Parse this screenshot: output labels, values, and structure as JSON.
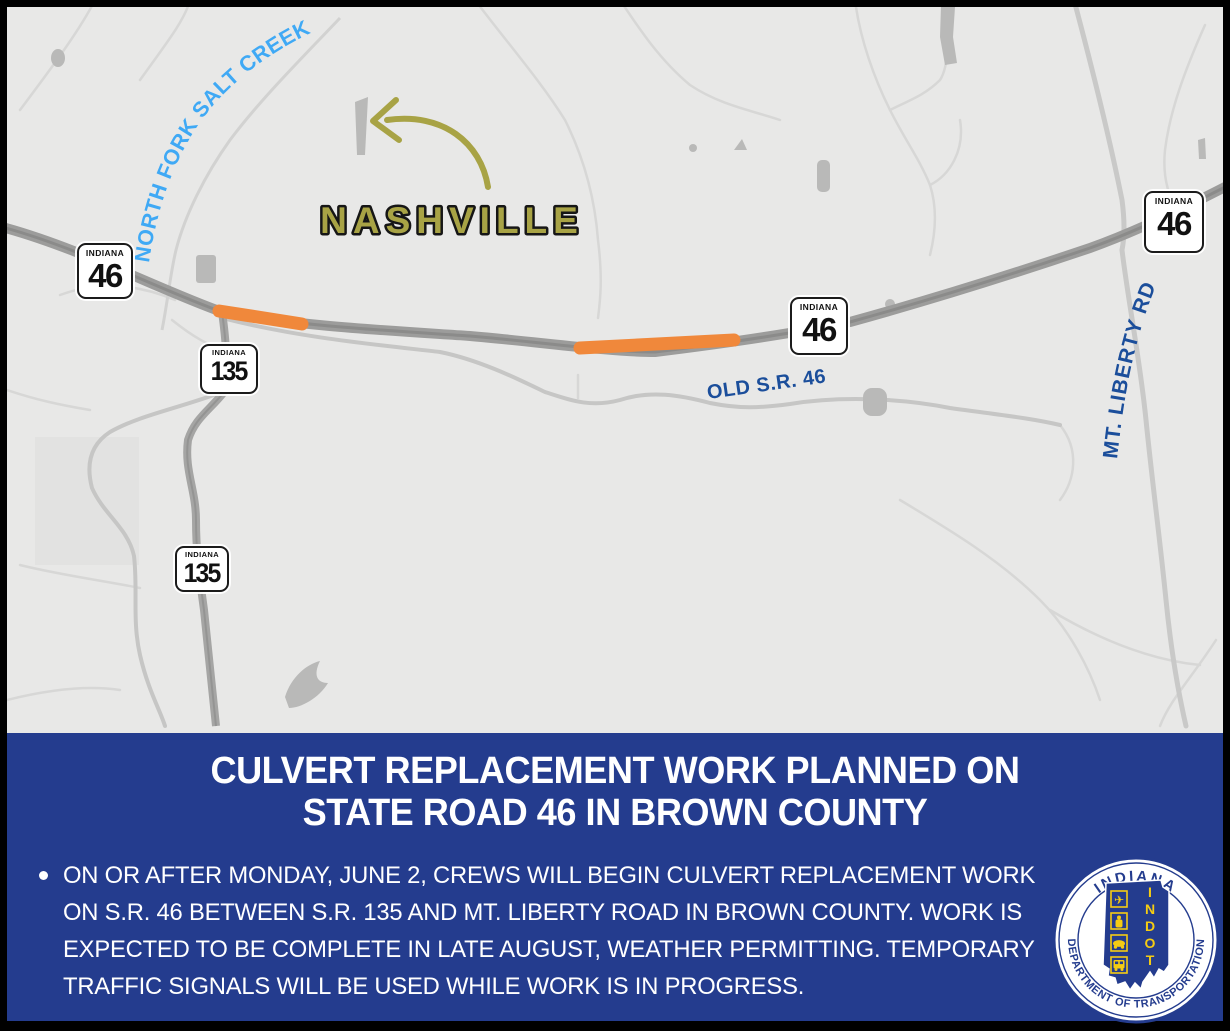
{
  "map": {
    "labels": {
      "creek": "NORTH FORK SALT CREEK",
      "city": "NASHVILLE",
      "old_road": "OLD S.R. 46",
      "mt_liberty_road": "MT. LIBERTY RD"
    },
    "shields": [
      {
        "state": "INDIANA",
        "route": "46"
      },
      {
        "state": "INDIANA",
        "route": "135"
      },
      {
        "state": "INDIANA",
        "route": "135"
      },
      {
        "state": "INDIANA",
        "route": "46"
      },
      {
        "state": "INDIANA",
        "route": "46"
      }
    ],
    "colors": {
      "work_zone_orange": "#F0883B",
      "creek_label_blue": "#3FA9F5",
      "road_label_blue": "#1B4E9B",
      "city_label_gold": "#A8A345",
      "map_background": "#e8e8e7"
    }
  },
  "banner": {
    "background_blue": "#243C8E",
    "title_lines": [
      "CULVERT REPLACEMENT WORK PLANNED ON",
      "STATE ROAD 46 IN BROWN COUNTY"
    ],
    "bullet_marker": "•",
    "bullet_lines": [
      "ON OR AFTER MONDAY, JUNE 2, CREWS WILL BEGIN CULVERT REPLACEMENT WORK",
      "ON S.R. 46 BETWEEN S.R. 135 AND MT. LIBERTY ROAD IN BROWN COUNTY. WORK IS",
      "EXPECTED TO BE COMPLETE IN LATE AUGUST, WEATHER PERMITTING. TEMPORARY",
      "TRAFFIC SIGNALS WILL BE USED WHILE WORK IS IN PROGRESS."
    ]
  },
  "logo": {
    "arc_top": "INDIANA",
    "arc_bottom": "DEPARTMENT OF TRANSPORTATION",
    "acronym_letters": [
      "I",
      "N",
      "D",
      "O",
      "T"
    ]
  }
}
